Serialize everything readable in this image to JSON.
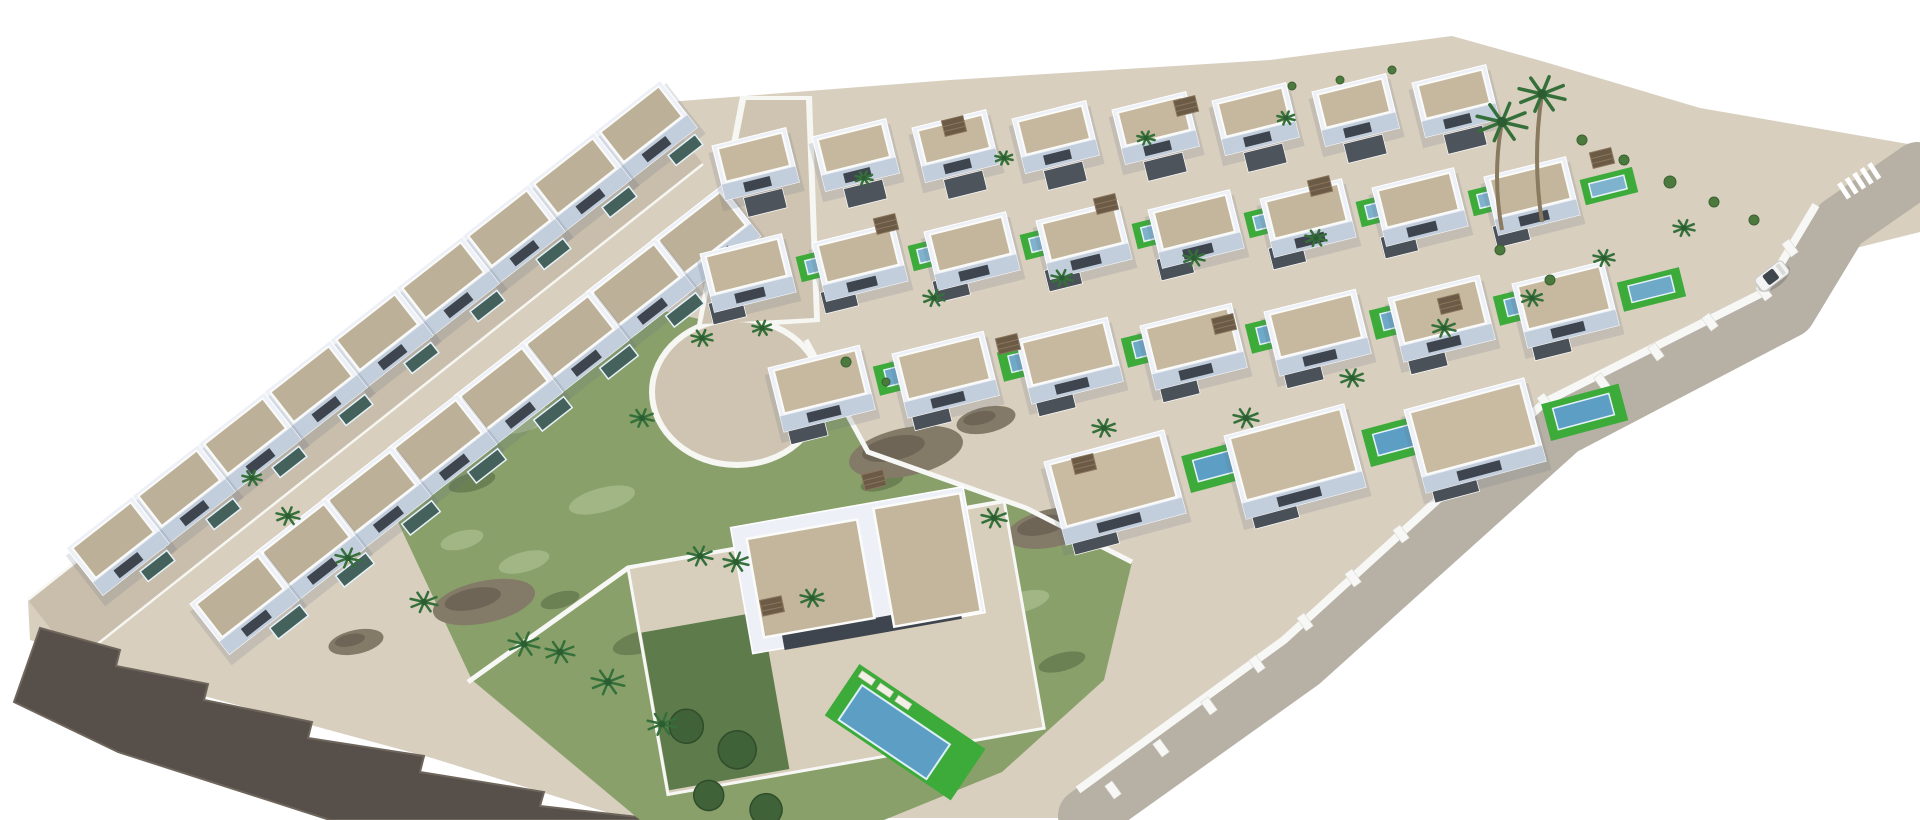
{
  "scene": {
    "description": "Aerial 3D architectural rendering of a white Mediterranean villa development: staircase rows of terraced villas with gravel roof terraces along an upper-left perimeter road, a grid of detached villas with private pools and bright green lawns on the right, an internal cul-de-sac road, a central undeveloped green scrub plot with rocky outcrops, a dark stepped rock cliff at the lower-left site edge, a perimeter road on the right with a white car and a zebra crossing, and scattered palm trees",
    "background": "#ffffff",
    "palette": {
      "sand_ground": "#d8cfbf",
      "left_road": "#c9bdab",
      "internal_road": "#cfc4b1",
      "right_road": "#b7b0a5",
      "curb_white": "#f6f6f2",
      "villa_wall": "#edf1f7",
      "villa_facade_shade": "#c3cedd",
      "villa_opening": "#3e454e",
      "roof_gravel": "#c4b69d",
      "annex_dark_roof": "#4b5159",
      "pool_blue": "#5d9fc4",
      "pool_dark_teal": "#45615c",
      "lawn_green": "#3dab3a",
      "scrub_green": "#8aa06b",
      "scrub_light": "#a9bd8d",
      "scrub_dark": "#63794f",
      "rock_cliff": "#57504a",
      "rock_outcrop": "#847a68",
      "palm_frond": "#35703a",
      "palm_trunk": "#8a7a5f",
      "wall_white": "#f7f8f5",
      "car_white": "#f2f3f2"
    },
    "ground": {
      "points": "655,103 950,80 1270,60 1452,36 1545,62 1700,108 1920,146 1920,232 1800,262 1758,316 1560,426 1300,664 1085,818 625,818 432,758 182,690 30,640 28,600"
    },
    "left_road": {
      "quad": "28,600 655,103 703,164 76,661",
      "edges": [
        "28,600 655,103",
        "76,661 703,164"
      ]
    },
    "internal_road": {
      "curb_quad": "740,96 812,96 820,322 696,330",
      "quad": "746,100 806,100 814,318 702,324",
      "curb_bulb": [
        737,
        392,
        88,
        76
      ],
      "bulb": [
        737,
        392,
        82,
        70
      ]
    },
    "green": {
      "points": "642,306 800,342 868,452 1024,506 1132,562 1104,680 1002,772 884,820 640,820 472,680 398,522 428,424 545,330",
      "speckles_light": [
        [
          522,
          420,
          30,
          12
        ],
        [
          602,
          500,
          34,
          12
        ],
        [
          702,
          622,
          40,
          14
        ],
        [
          852,
          560,
          36,
          12
        ],
        [
          952,
          642,
          30,
          10
        ],
        [
          524,
          562,
          26,
          10
        ],
        [
          782,
          432,
          28,
          10
        ],
        [
          902,
          722,
          34,
          12
        ],
        [
          1022,
          602,
          28,
          10
        ],
        [
          462,
          540,
          22,
          9
        ]
      ],
      "speckles_dark": [
        [
          472,
          482,
          24,
          9
        ],
        [
          642,
          642,
          30,
          11
        ],
        [
          762,
          702,
          26,
          9
        ],
        [
          882,
          482,
          22,
          8
        ],
        [
          1062,
          662,
          24,
          9
        ],
        [
          560,
          600,
          20,
          8
        ]
      ],
      "outcrops": [
        [
          906,
          452,
          58,
          24
        ],
        [
          1052,
          528,
          46,
          19
        ],
        [
          484,
          602,
          52,
          21
        ],
        [
          356,
          642,
          28,
          12
        ],
        [
          986,
          420,
          30,
          13
        ]
      ]
    },
    "rock": {
      "points": "40,628 120,650 116,666 208,684 204,700 312,722 308,738 424,756 420,772 544,792 540,806 665,820 330,820 118,752 14,702"
    },
    "right_road": {
      "path": "M1918,170 L1840,224 L1788,310 L1562,428 L1302,662 L1086,816",
      "width": 56,
      "wall": "1816,205 1764,292 1545,402 1284,640 1078,790",
      "pillars": [
        [
          1790,
          248
        ],
        [
          1764,
          292
        ],
        [
          1710,
          322
        ],
        [
          1656,
          352
        ],
        [
          1602,
          382
        ],
        [
          1545,
          402
        ],
        [
          1497,
          446
        ],
        [
          1449,
          490
        ],
        [
          1401,
          534
        ],
        [
          1353,
          578
        ],
        [
          1305,
          622
        ],
        [
          1257,
          664
        ],
        [
          1209,
          706
        ],
        [
          1161,
          748
        ],
        [
          1113,
          790
        ]
      ],
      "zebra": [
        1842,
        192,
        -33,
        5
      ],
      "car": [
        1772,
        276,
        -37
      ]
    },
    "walls": [
      "806,340 868,452 1026,508 1132,562",
      "468,682 628,568 1002,502"
    ],
    "villa_rows": [
      {
        "x": 594,
        "y": 132,
        "dx": -66,
        "dy": 52,
        "n": 9,
        "w": 84,
        "h": 60,
        "rot": -38,
        "roof": "#bdb098",
        "pool": {
          "ox": 44,
          "oy": 64,
          "w": 34,
          "h": 13,
          "fill": "#45615c"
        }
      },
      {
        "x": 652,
        "y": 240,
        "dx": -66,
        "dy": 52,
        "n": 8,
        "w": 88,
        "h": 64,
        "rot": -38,
        "roof": "#bdb098",
        "pool": {
          "ox": 48,
          "oy": 68,
          "w": 38,
          "h": 14,
          "fill": "#45615c"
        }
      },
      {
        "x": 712,
        "y": 146,
        "dx": 100,
        "dy": -9,
        "n": 8,
        "w": 76,
        "h": 56,
        "rot": -14,
        "roof": "#c6b89f",
        "annex": {
          "ox": 18,
          "oy": 58,
          "w": 40,
          "h": 20,
          "fill": "#4d545c"
        }
      },
      {
        "x": 700,
        "y": 254,
        "dx": 112,
        "dy": -11,
        "n": 8,
        "w": 84,
        "h": 60,
        "rot": -14,
        "roof": "#c4b69d",
        "annex": {
          "ox": -4,
          "oy": 50,
          "w": 34,
          "h": 22,
          "fill": "#4b5159"
        },
        "lawn": {
          "ox": 92,
          "oy": 26,
          "w": 54,
          "h": 26,
          "fill": "#3dab3a"
        },
        "pool": {
          "ox": 100,
          "oy": 32,
          "w": 36,
          "h": 14,
          "fill": "#7fb3cd"
        }
      },
      {
        "x": 768,
        "y": 368,
        "dx": 124,
        "dy": -14,
        "n": 7,
        "w": 94,
        "h": 66,
        "rot": -14,
        "roof": "#c7b99f",
        "annex": {
          "ox": 4,
          "oy": 56,
          "w": 38,
          "h": 24,
          "fill": "#4b5159"
        },
        "lawn": {
          "ox": 102,
          "oy": 24,
          "w": 64,
          "h": 30,
          "fill": "#3dab3a"
        },
        "pool": {
          "ox": 112,
          "oy": 30,
          "w": 44,
          "h": 17,
          "fill": "#6ea9c8"
        }
      },
      {
        "x": 1044,
        "y": 462,
        "dx": 180,
        "dy": -26,
        "n": 3,
        "w": 124,
        "h": 86,
        "rot": -15,
        "roof": "#c9bba1",
        "annex": {
          "ox": 6,
          "oy": 72,
          "w": 46,
          "h": 26,
          "fill": "#4a5058"
        },
        "lawn": {
          "ox": 134,
          "oy": 30,
          "w": 80,
          "h": 38,
          "fill": "#3dab3a"
        },
        "pool": {
          "ox": 144,
          "oy": 37,
          "w": 58,
          "h": 22,
          "fill": "#5d9fc4"
        }
      }
    ],
    "hero": {
      "x": 628,
      "y": 568,
      "rot": -10,
      "pad_w": 382,
      "pad_h": 230,
      "garden": {
        "x": 2,
        "y": 66,
        "w": 122,
        "h": 160,
        "trees": [
          [
            28,
            100,
            17
          ],
          [
            74,
            132,
            19
          ],
          [
            38,
            172,
            15
          ],
          [
            92,
            196,
            16
          ]
        ]
      },
      "body": {
        "x": 108,
        "y": -22,
        "w": 236,
        "h": 128
      },
      "roofs": [
        [
          122,
          -8,
          112,
          100
        ],
        [
          252,
          -16,
          88,
          120
        ]
      ],
      "opening": [
        140,
        92,
        180,
        16
      ],
      "pool": {
        "x": 852,
        "y": 700,
        "rot": 34,
        "lawn": [
          -14,
          -34,
          152,
          62
        ],
        "water": [
          0,
          -18,
          106,
          42
        ],
        "loungers": [
          [
            -8,
            -30
          ],
          [
            14,
            -30
          ],
          [
            36,
            -30
          ]
        ]
      }
    },
    "palms": [
      [
        288,
        516,
        12
      ],
      [
        348,
        558,
        13
      ],
      [
        424,
        602,
        14
      ],
      [
        524,
        644,
        16
      ],
      [
        608,
        682,
        17
      ],
      [
        662,
        724,
        15
      ],
      [
        252,
        478,
        10
      ],
      [
        702,
        338,
        11
      ],
      [
        762,
        328,
        10
      ],
      [
        642,
        418,
        12
      ],
      [
        700,
        556,
        13
      ],
      [
        812,
        598,
        12
      ],
      [
        560,
        652,
        15
      ],
      [
        736,
        562,
        13
      ],
      [
        934,
        298,
        11
      ],
      [
        1062,
        278,
        11
      ],
      [
        1194,
        258,
        11
      ],
      [
        1316,
        238,
        11
      ],
      [
        1246,
        418,
        13
      ],
      [
        1104,
        428,
        12
      ],
      [
        994,
        518,
        13
      ],
      [
        1352,
        378,
        12
      ],
      [
        1444,
        328,
        12
      ],
      [
        1532,
        298,
        11
      ],
      [
        1604,
        258,
        11
      ],
      [
        1684,
        228,
        11
      ],
      [
        864,
        178,
        9
      ],
      [
        1004,
        158,
        9
      ],
      [
        1146,
        138,
        9
      ],
      [
        1286,
        118,
        9
      ],
      [
        1502,
        122,
        26,
        108
      ],
      [
        1542,
        94,
        24,
        128
      ]
    ],
    "pergolas": [
      [
        886,
        224,
        -14
      ],
      [
        1106,
        204,
        -14
      ],
      [
        1320,
        186,
        -14
      ],
      [
        1008,
        344,
        -14
      ],
      [
        1224,
        324,
        -14
      ],
      [
        1450,
        304,
        -14
      ],
      [
        874,
        480,
        -14
      ],
      [
        1084,
        464,
        -14
      ],
      [
        1602,
        158,
        -14
      ],
      [
        772,
        606,
        -12
      ],
      [
        954,
        126,
        -14
      ],
      [
        1186,
        106,
        -14
      ]
    ],
    "bushes": [
      [
        1582,
        140,
        5
      ],
      [
        1624,
        160,
        5
      ],
      [
        1670,
        182,
        6
      ],
      [
        1714,
        202,
        5
      ],
      [
        1754,
        220,
        5
      ],
      [
        1292,
        86,
        4
      ],
      [
        1340,
        80,
        4
      ],
      [
        1392,
        70,
        4
      ],
      [
        846,
        362,
        5
      ],
      [
        886,
        382,
        4
      ],
      [
        1500,
        250,
        5
      ],
      [
        1550,
        280,
        5
      ]
    ]
  }
}
